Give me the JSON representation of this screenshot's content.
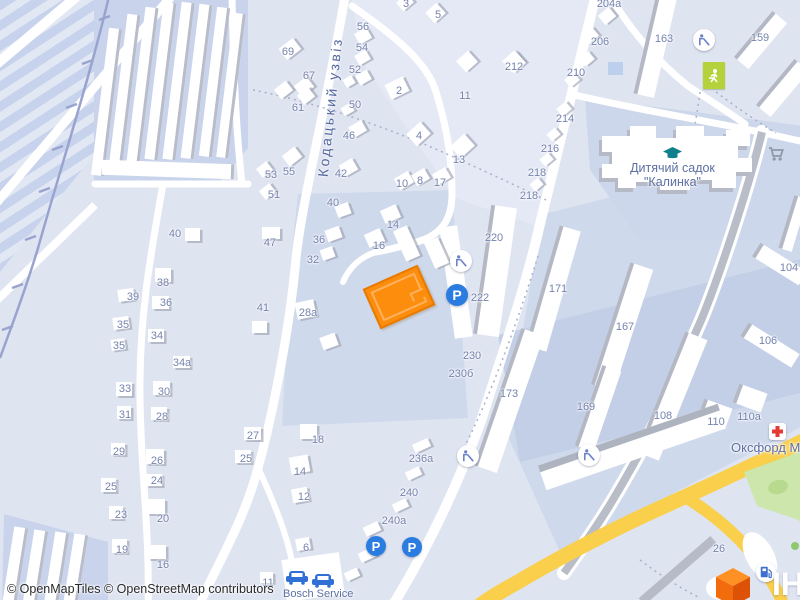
{
  "map_ui": {
    "street_name": "Кодацький узвіз",
    "kindergarten_line1": "Дитячий садок",
    "kindergarten_line2": "\"Калинка\"",
    "medical_center_label": "Оксфорд Мед",
    "car_service_label": "Bosch Service",
    "attribution": "© OpenMapTiles © OpenStreetMap contributors",
    "watermark_fragment": "ІН",
    "parking_glyph": "P",
    "colors": {
      "background": "#dfe4f1",
      "block_light": "#e4e9f5",
      "block_shaded": "#cfd9ec",
      "parking_lot": "#c3cfe6",
      "road_white": "#ffffff",
      "road_gray": "#b9bdc8",
      "road_yellow": "#f9cf4b",
      "green_area": "#cde6ac",
      "sports_field": "#b5d23d",
      "railway": "#99a3cf",
      "building_edge": "#b3b8c4",
      "highlight_building": "#fc8d0d",
      "house_number_text": "#7583ae",
      "poi_text": "#5d70a4",
      "parking_blue": "#2b7ce0",
      "school_icon": "#0f7f8b",
      "medical_red": "#e53935"
    },
    "house_numbers": [
      [
        "69",
        288,
        52
      ],
      [
        "67",
        309,
        76
      ],
      [
        "61",
        298,
        108
      ],
      [
        "55",
        289,
        172
      ],
      [
        "53",
        271,
        175
      ],
      [
        "51",
        274,
        195
      ],
      [
        "56",
        363,
        27
      ],
      [
        "54",
        362,
        48
      ],
      [
        "52",
        355,
        70
      ],
      [
        "50",
        355,
        105
      ],
      [
        "46",
        349,
        136
      ],
      [
        "42",
        341,
        174
      ],
      [
        "40",
        333,
        203
      ],
      [
        "36",
        319,
        240
      ],
      [
        "32",
        313,
        260
      ],
      [
        "28а",
        308,
        313
      ],
      [
        "3",
        406,
        4
      ],
      [
        "5",
        438,
        15
      ],
      [
        "2",
        399,
        91
      ],
      [
        "11",
        465,
        96
      ],
      [
        "4",
        419,
        136
      ],
      [
        "13",
        459,
        160
      ],
      [
        "10",
        402,
        184
      ],
      [
        "8",
        420,
        181
      ],
      [
        "17",
        440,
        183
      ],
      [
        "14",
        393,
        225
      ],
      [
        "16",
        379,
        246
      ],
      [
        "212",
        514,
        67
      ],
      [
        "204а",
        609,
        4
      ],
      [
        "206",
        600,
        42
      ],
      [
        "210",
        576,
        73
      ],
      [
        "214",
        565,
        119
      ],
      [
        "216",
        550,
        149
      ],
      [
        "218",
        537,
        173
      ],
      [
        "218",
        529,
        196
      ],
      [
        "163",
        664,
        39
      ],
      [
        "159",
        760,
        38
      ],
      [
        "171",
        558,
        289
      ],
      [
        "167",
        625,
        327
      ],
      [
        "220",
        494,
        238
      ],
      [
        "222",
        480,
        298
      ],
      [
        "230",
        472,
        356
      ],
      [
        "230б",
        461,
        374
      ],
      [
        "173",
        509,
        394
      ],
      [
        "169",
        586,
        407
      ],
      [
        "104",
        789,
        268
      ],
      [
        "106",
        768,
        341
      ],
      [
        "108",
        663,
        416
      ],
      [
        "110",
        716,
        422
      ],
      [
        "110а",
        749,
        417
      ],
      [
        "26",
        719,
        549
      ],
      [
        "40",
        175,
        234
      ],
      [
        "47",
        270,
        243
      ],
      [
        "38",
        163,
        283
      ],
      [
        "39",
        133,
        297
      ],
      [
        "36",
        166,
        303
      ],
      [
        "41",
        263,
        308
      ],
      [
        "35",
        123,
        325
      ],
      [
        "34",
        157,
        336
      ],
      [
        "35",
        119,
        346
      ],
      [
        "34а",
        182,
        363
      ],
      [
        "33",
        125,
        389
      ],
      [
        "30",
        164,
        392
      ],
      [
        "31",
        125,
        415
      ],
      [
        "28",
        162,
        417
      ],
      [
        "27",
        253,
        436
      ],
      [
        "29",
        119,
        452
      ],
      [
        "26",
        157,
        461
      ],
      [
        "25",
        246,
        459
      ],
      [
        "24",
        157,
        481
      ],
      [
        "25",
        111,
        487
      ],
      [
        "23",
        121,
        515
      ],
      [
        "20",
        163,
        519
      ],
      [
        "19",
        122,
        550
      ],
      [
        "16",
        163,
        565
      ],
      [
        "18",
        318,
        440
      ],
      [
        "14",
        300,
        472
      ],
      [
        "12",
        304,
        497
      ],
      [
        "236а",
        421,
        459
      ],
      [
        "240",
        409,
        493
      ],
      [
        "240а",
        394,
        521
      ],
      [
        "6",
        306,
        548
      ],
      [
        "11",
        268,
        583
      ]
    ],
    "houses": [
      [
        281,
        42,
        18,
        14,
        -38
      ],
      [
        296,
        80,
        16,
        13,
        -38
      ],
      [
        276,
        84,
        15,
        12,
        -38
      ],
      [
        284,
        150,
        16,
        13,
        -38
      ],
      [
        258,
        164,
        13,
        11,
        -38
      ],
      [
        261,
        186,
        13,
        11,
        -38
      ],
      [
        299,
        90,
        14,
        12,
        -38
      ],
      [
        356,
        30,
        14,
        12,
        -30
      ],
      [
        356,
        52,
        13,
        11,
        -30
      ],
      [
        357,
        72,
        13,
        11,
        -30
      ],
      [
        344,
        77,
        10,
        9,
        -30
      ],
      [
        342,
        105,
        11,
        9,
        -30
      ],
      [
        350,
        123,
        15,
        12,
        -30
      ],
      [
        341,
        161,
        15,
        13,
        -30
      ],
      [
        336,
        204,
        14,
        12,
        -20
      ],
      [
        326,
        228,
        15,
        12,
        -20
      ],
      [
        321,
        248,
        13,
        11,
        -20
      ],
      [
        296,
        301,
        19,
        17,
        -12
      ],
      [
        398,
        -3,
        14,
        11,
        -40
      ],
      [
        428,
        6,
        15,
        14,
        -42
      ],
      [
        387,
        80,
        20,
        16,
        -26
      ],
      [
        459,
        54,
        16,
        15,
        -42
      ],
      [
        505,
        54,
        16,
        15,
        -42
      ],
      [
        409,
        126,
        19,
        16,
        -42
      ],
      [
        453,
        138,
        19,
        16,
        -42
      ],
      [
        396,
        174,
        16,
        13,
        -30
      ],
      [
        413,
        171,
        15,
        12,
        -30
      ],
      [
        434,
        170,
        15,
        12,
        -30
      ],
      [
        382,
        207,
        17,
        14,
        -24
      ],
      [
        366,
        231,
        17,
        14,
        -24
      ],
      [
        600,
        10,
        14,
        12,
        -40
      ],
      [
        584,
        30,
        13,
        11,
        -40
      ],
      [
        581,
        54,
        12,
        10,
        -40
      ],
      [
        566,
        75,
        12,
        10,
        -40
      ],
      [
        558,
        104,
        12,
        10,
        -40
      ],
      [
        548,
        130,
        11,
        9,
        -40
      ],
      [
        541,
        155,
        11,
        9,
        -40
      ],
      [
        531,
        180,
        11,
        9,
        -40
      ],
      [
        185,
        228,
        15,
        13,
        0
      ],
      [
        262,
        227,
        18,
        12,
        0
      ],
      [
        155,
        268,
        16,
        14,
        0
      ],
      [
        118,
        289,
        16,
        12,
        -8
      ],
      [
        152,
        296,
        17,
        13,
        0
      ],
      [
        252,
        321,
        15,
        12,
        0
      ],
      [
        113,
        317,
        16,
        12,
        -8
      ],
      [
        148,
        329,
        16,
        13,
        0
      ],
      [
        111,
        339,
        14,
        11,
        -8
      ],
      [
        173,
        356,
        17,
        12,
        0
      ],
      [
        116,
        382,
        16,
        14,
        0
      ],
      [
        153,
        381,
        17,
        14,
        0
      ],
      [
        117,
        406,
        14,
        13,
        0
      ],
      [
        151,
        407,
        16,
        13,
        0
      ],
      [
        244,
        427,
        17,
        13,
        0
      ],
      [
        111,
        443,
        14,
        12,
        0
      ],
      [
        146,
        449,
        18,
        15,
        0
      ],
      [
        235,
        450,
        16,
        13,
        0
      ],
      [
        146,
        474,
        16,
        12,
        0
      ],
      [
        101,
        478,
        15,
        14,
        0
      ],
      [
        109,
        506,
        14,
        13,
        0
      ],
      [
        147,
        499,
        18,
        15,
        0
      ],
      [
        112,
        539,
        15,
        14,
        0
      ],
      [
        148,
        545,
        18,
        14,
        0
      ],
      [
        300,
        424,
        17,
        15,
        0
      ],
      [
        290,
        456,
        19,
        17,
        -10
      ],
      [
        292,
        488,
        16,
        14,
        -10
      ],
      [
        296,
        538,
        14,
        12,
        -10
      ],
      [
        260,
        572,
        13,
        11,
        0
      ],
      [
        413,
        441,
        17,
        9,
        -25
      ],
      [
        406,
        469,
        15,
        9,
        -25
      ],
      [
        393,
        501,
        15,
        9,
        -25
      ],
      [
        364,
        524,
        16,
        10,
        -25
      ],
      [
        359,
        550,
        16,
        10,
        -25
      ],
      [
        345,
        570,
        14,
        9,
        -25
      ],
      [
        399,
        227,
        15,
        33,
        -24
      ],
      [
        429,
        239,
        15,
        28,
        -24
      ],
      [
        321,
        335,
        16,
        13,
        -20
      ],
      [
        507,
        55,
        16,
        15,
        -42
      ]
    ],
    "buildings": [
      [
        100,
        28,
        13,
        148,
        7,
        "r"
      ],
      [
        118,
        14,
        13,
        155,
        7,
        "r"
      ],
      [
        136,
        7,
        13,
        156,
        7,
        "r"
      ],
      [
        154,
        2,
        13,
        158,
        7,
        "r"
      ],
      [
        172,
        2,
        13,
        158,
        7,
        "r"
      ],
      [
        190,
        4,
        13,
        155,
        7,
        "r"
      ],
      [
        208,
        7,
        13,
        150,
        7,
        "r"
      ],
      [
        225,
        13,
        12,
        145,
        7,
        "r"
      ],
      [
        102,
        162,
        132,
        15,
        2,
        "r"
      ],
      [
        8,
        527,
        14,
        80,
        9,
        "r"
      ],
      [
        28,
        530,
        14,
        80,
        9,
        "r"
      ],
      [
        49,
        532,
        14,
        80,
        9,
        "r"
      ],
      [
        68,
        534,
        14,
        80,
        9,
        "r"
      ],
      [
        645,
        -8,
        21,
        105,
        13,
        "l"
      ],
      [
        751,
        10,
        19,
        60,
        40,
        "l"
      ],
      [
        773,
        58,
        19,
        60,
        40,
        "l"
      ],
      [
        786,
        196,
        14,
        55,
        17,
        "l"
      ],
      [
        542,
        226,
        22,
        125,
        16,
        "l"
      ],
      [
        610,
        263,
        24,
        128,
        18,
        "l"
      ],
      [
        482,
        206,
        26,
        130,
        8,
        "l"
      ],
      [
        497,
        328,
        24,
        145,
        19,
        "l"
      ],
      [
        588,
        366,
        20,
        85,
        19,
        "l"
      ],
      [
        660,
        331,
        24,
        130,
        22,
        "l"
      ],
      [
        700,
        403,
        30,
        20,
        20,
        "l"
      ],
      [
        735,
        388,
        30,
        20,
        20,
        "l"
      ],
      [
        752,
        256,
        55,
        16,
        32,
        "l"
      ],
      [
        740,
        337,
        60,
        16,
        32,
        "l"
      ],
      [
        537,
        434,
        190,
        26,
        -19,
        "t"
      ],
      [
        630,
        566,
        95,
        9,
        -41,
        "g"
      ],
      [
        447,
        226,
        18,
        112,
        -8,
        "n"
      ],
      [
        284,
        556,
        58,
        42,
        -8,
        "n"
      ]
    ]
  }
}
